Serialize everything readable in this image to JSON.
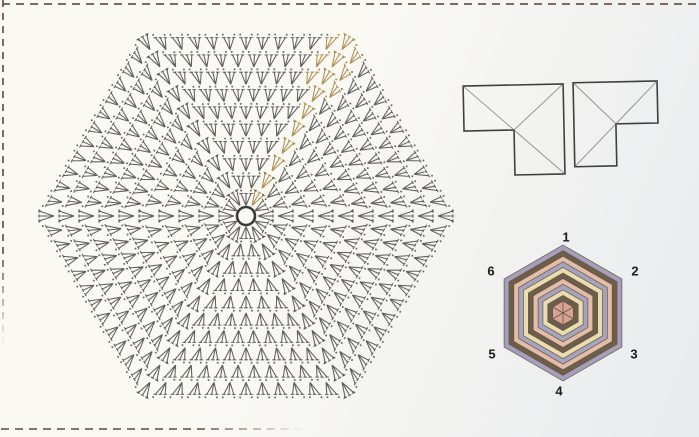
{
  "page": {
    "kind": "scanned crochet pattern page",
    "background_left": "#faf9f4",
    "background_right": "#e8eaed",
    "border_dash_color": "#6b5145"
  },
  "crochet_chart": {
    "kind": "hexagonal crochet motif chart",
    "rounds": 10,
    "stitch_symbol": "3-double-crochet cluster with chain dots",
    "center_symbol": "chain ring",
    "stitch_color": "#4a4a4a",
    "round_start_highlight_color": "#ab8a4a",
    "highlight_direction": "center to upper-right corner"
  },
  "assembly_diagram": {
    "kind": "piecing / fold diagram",
    "line_color": "#3f3f3f",
    "fold_line_color": "#6a6a6a",
    "shapes": [
      {
        "name": "left-l-shape",
        "squares": 3,
        "tail": "bottom-right",
        "fold_lines": 3
      },
      {
        "name": "right-l-shape",
        "squares": 3,
        "tail": "bottom-left",
        "fold_lines": 3
      }
    ]
  },
  "colored_hexagon": {
    "kind": "color sequence key with numbered sides",
    "side_labels": [
      "1",
      "2",
      "3",
      "4",
      "5",
      "6"
    ],
    "ring_colors_outer_to_inner": [
      "#a59fb9",
      "#6f5c49",
      "#e3bda5",
      "#a8a3bc",
      "#e9dcae",
      "#6f5c49",
      "#e3bda5",
      "#a8a3bc",
      "#e9dcae",
      "#6f5c49"
    ],
    "center_color": "#d7a28e",
    "outline_color": "#60564b",
    "label_color": "#1c1c1c"
  }
}
